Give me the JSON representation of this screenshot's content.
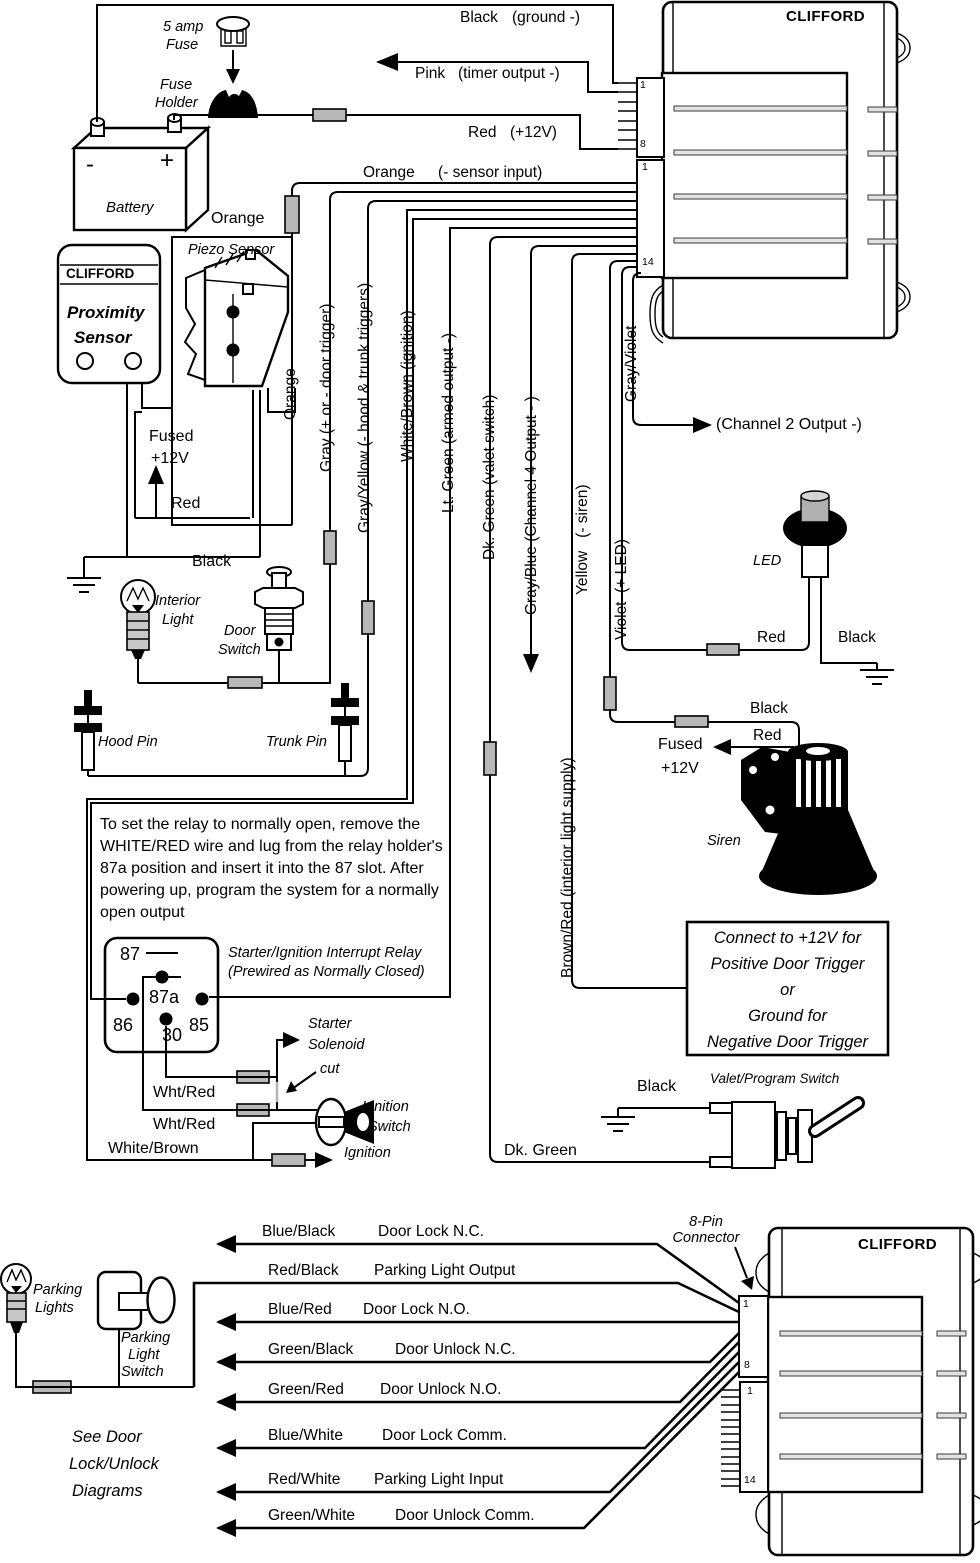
{
  "top_unit": {
    "brand": "CLIFFORD",
    "pin1": "1",
    "pin8": "8",
    "pin1b": "1",
    "pin14": "14"
  },
  "bottom_unit": {
    "brand": "CLIFFORD",
    "pin1": "1",
    "pin8": "8",
    "pin1b": "1",
    "pin14": "14",
    "conn_label1": "8-Pin",
    "conn_label2": "Connector"
  },
  "power": {
    "fuse1": "5 amp",
    "fuse2": "Fuse",
    "holder1": "Fuse",
    "holder2": "Holder",
    "battery": "Battery",
    "neg": "-",
    "pos": "+"
  },
  "unit_wires": {
    "black": "Black",
    "black_desc": "(ground -)",
    "pink": "Pink",
    "pink_desc": "(timer output -)",
    "red": "Red",
    "red_desc": "(+12V)",
    "orange": "Orange",
    "orange_desc": "(- sensor input)",
    "orange_splice": "Orange",
    "orange_vert": "Orange",
    "gray": "Gray (+ or - door trigger)",
    "gray_yellow": "Gray/Yellow (- hood & trunk triggers)",
    "white_brown": "White/Brown (ignition)",
    "lt_green": "Lt. Green (armed output -)",
    "dk_green": "Dk. Green (valet switch)",
    "gray_blue": "Gray/Blue (Channel 4 Output - )",
    "yellow": "Yellow   (- siren)",
    "violet": "Violet  (+ LED)",
    "gray_violet": "Gray/Violet",
    "brown_red": "Brown/Red (interior light supply)",
    "channel2": "(Channel 2 Output -)"
  },
  "sensors": {
    "prox_brand": "CLIFFORD",
    "prox1": "Proximity",
    "prox2": "Sensor",
    "piezo": "Piezo Sensor",
    "fused1": "Fused",
    "fused2": "+12V",
    "red": "Red",
    "black": "Black"
  },
  "cabin": {
    "interior1": "Interior",
    "interior2": "Light",
    "door1": "Door",
    "door2": "Switch",
    "hood": "Hood Pin",
    "trunk": "Trunk Pin"
  },
  "relay": {
    "note": [
      "To set the relay to normally open, remove the",
      "WHITE/RED wire and lug from the relay holder's",
      "87a position and insert it into the 87 slot. After",
      "powering up, program the system for a normally",
      "open output"
    ],
    "p87": "87",
    "p87a": "87a",
    "p86": "86",
    "p85": "85",
    "p30": "30",
    "cap1": "Starter/Ignition Interrupt Relay",
    "cap2": "(Prewired as Normally Closed)",
    "starter1": "Starter",
    "starter2": "Solenoid",
    "cut": "cut",
    "whtred1": "Wht/Red",
    "whtred2": "Wht/Red",
    "whitebrown": "White/Brown",
    "ignition": "Ignition",
    "ignsw1": "Ignition",
    "ignsw2": "Switch"
  },
  "outputs": {
    "led": "LED",
    "led_red": "Red",
    "led_black": "Black",
    "siren": "Siren",
    "siren_black": "Black",
    "siren_red": "Red",
    "fused1": "Fused",
    "fused2": "+12V",
    "box": [
      "Connect to +12V for",
      "Positive Door Trigger",
      "or",
      "Ground for",
      "Negative Door Trigger"
    ]
  },
  "valet": {
    "black": "Black",
    "label": "Valet/Program Switch",
    "dk_green": "Dk. Green"
  },
  "door_lock": {
    "rows": [
      {
        "wire": "Blue/Black",
        "desc": "Door Lock N.C."
      },
      {
        "wire": "Red/Black",
        "desc": "Parking Light Output"
      },
      {
        "wire": "Blue/Red",
        "desc": "Door Lock N.O."
      },
      {
        "wire": "Green/Black",
        "desc": "Door Unlock N.C."
      },
      {
        "wire": "Green/Red",
        "desc": "Door Unlock N.O."
      },
      {
        "wire": "Blue/White",
        "desc": "Door Lock Comm."
      },
      {
        "wire": "Red/White",
        "desc": "Parking Light Input"
      },
      {
        "wire": "Green/White",
        "desc": "Door Unlock Comm."
      }
    ],
    "see1": "See Door",
    "see2": "Lock/Unlock",
    "see3": "Diagrams",
    "parking1": "Parking",
    "parking2": "Lights",
    "switch1": "Parking",
    "switch2": "Light",
    "switch3": "Switch"
  }
}
